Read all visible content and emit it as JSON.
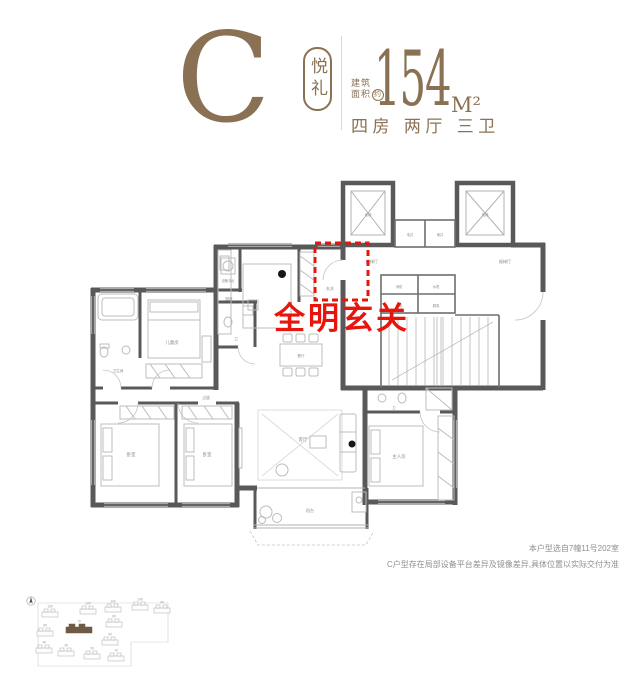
{
  "header": {
    "unit_letter": "C",
    "badge": "悦礼",
    "area_label_line1": "建筑",
    "area_label_line2": "面积",
    "area_circle": "约",
    "area_value": "154",
    "area_unit": "M²",
    "rooms_summary": "四房 两厅 三卫"
  },
  "floorplan": {
    "highlight_text": "全明玄关",
    "labels": {
      "equip": "设备平台",
      "bath_left": "卫生间",
      "kids": "儿童房",
      "kitchen": "厨房",
      "foyer": "玄关",
      "dining": "餐厅",
      "living": "客厅",
      "bedroom1": "卧室",
      "bedroom2": "卧室",
      "master": "主人房",
      "bath_mid": "卫",
      "bath_master": "卫",
      "balcony": "阳台",
      "corridor": "过道",
      "lobby_left": "候梯厅",
      "lobby_right": "候梯厅",
      "elevator_left": "电梯",
      "elevator_right": "电梯",
      "well_left": "电井",
      "well_right": "管井",
      "util_fire": "消防",
      "util_water": "水表",
      "util_power": "强电",
      "util_weak": "弱电"
    }
  },
  "notes": {
    "line1": "本户型选自7幢11号202室",
    "line2": "C户型存在局部设备平台差异及镜像差异,具体位置以实际交付为准"
  },
  "siteplan": {
    "highlighted": "7#",
    "buildings": [
      {
        "label": "13#"
      },
      {
        "label": "12#"
      },
      {
        "label": "11#"
      },
      {
        "label": "10#"
      },
      {
        "label": "9#"
      },
      {
        "label": "8#"
      },
      {
        "label": "7#",
        "highlighted": true
      },
      {
        "label": "6#"
      },
      {
        "label": "5#"
      },
      {
        "label": "4#"
      },
      {
        "label": "3#"
      },
      {
        "label": "2#"
      },
      {
        "label": "1#"
      }
    ]
  },
  "colors": {
    "brand": "#8a7154",
    "highlight_red": "#e8150d",
    "wall": "#595959"
  }
}
